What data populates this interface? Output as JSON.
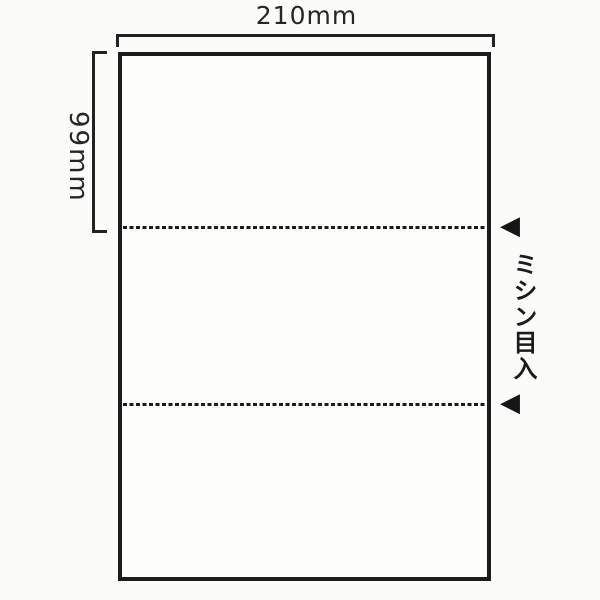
{
  "diagram": {
    "description_type": "perforated-sheet-dimension-diagram",
    "width_label": "210mm",
    "height_label": "99mm",
    "perforation_label": "ミシン目入",
    "sections": 3,
    "perforation_line_count": 2,
    "icons": {
      "perforation_arrow": "◀"
    },
    "colors": {
      "line": "#1c1c1c",
      "background": "#fbfbfa",
      "sheet_fill": "#fdfdfc"
    }
  }
}
